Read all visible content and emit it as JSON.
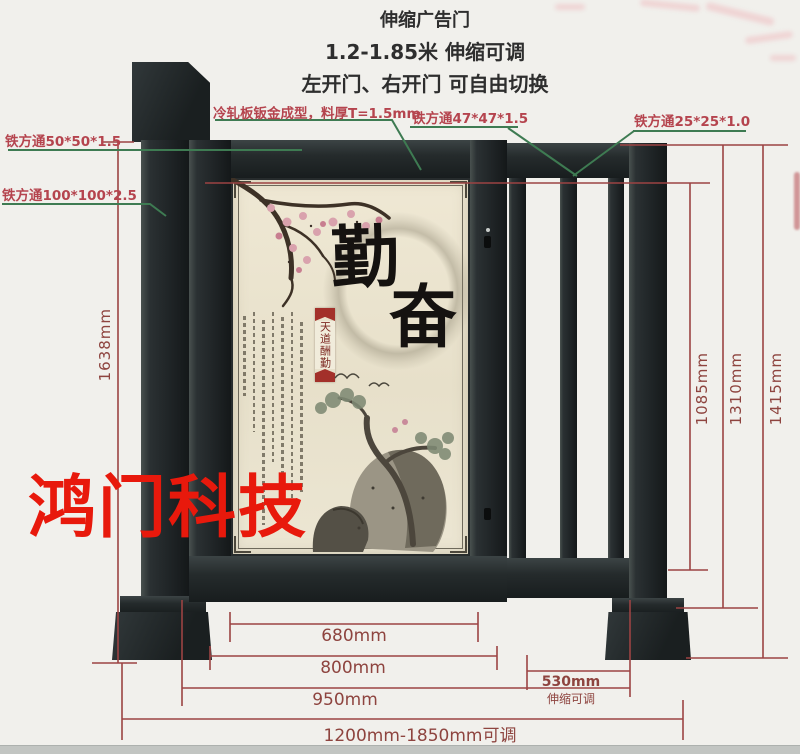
{
  "header": {
    "title": "伸缩广告门",
    "subtitle": "1.2-1.85米 伸缩可调",
    "subtitle2": "左开门、右开门 可自由切换"
  },
  "callouts": {
    "cold_rolled": "冷轧板钣金成型，料厚T=1.5mm",
    "tube_50": "铁方通50*50*1.5",
    "tube_100": "铁方通100*100*2.5",
    "tube_47": "铁方通47*47*1.5",
    "tube_25": "铁方通25*25*1.0"
  },
  "dimensions": {
    "left_height": "1638mm",
    "right_heights": [
      "1085mm",
      "1310mm",
      "1415mm"
    ],
    "bottom_widths": [
      "680mm",
      "800mm",
      "950mm"
    ],
    "total_width": "1200mm-1850mm可调",
    "telescopic_value": "530mm",
    "telescopic_note": "伸缩可调"
  },
  "panel_art": {
    "char_top": "勤",
    "char_bottom": "奋",
    "seal_text": "天道酬勤"
  },
  "watermark": "鸿门科技",
  "colors": {
    "dimension_line": "#9c4343",
    "dimension_text": "#8e443f",
    "callout_line": "#3e7b52",
    "callout_text": "#b5444e",
    "watermark_red": "#e8190c",
    "metal_dark": "#23282a",
    "panel_bg": "#ece5cf"
  }
}
